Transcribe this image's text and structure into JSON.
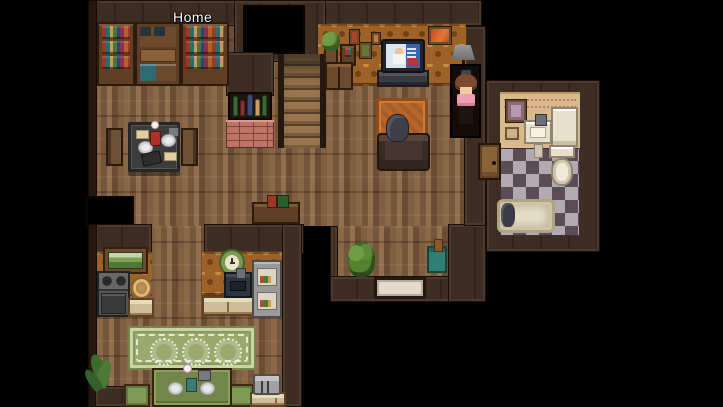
{
  "hud": {
    "map_name": "Home"
  },
  "scene": {
    "type": "top-down RPG house interior",
    "rooms": [
      "library-dining",
      "living-room",
      "bathroom",
      "kitchen",
      "entry-hall"
    ],
    "characters": {
      "player": "girl with brown hair, dark bow and pink dress standing in doorway",
      "npc": "dark-haired person sitting on sofa facing TV"
    },
    "objects": [
      "bookshelf",
      "china-hutch",
      "stairwell-opening",
      "staircase",
      "wine-rack",
      "brick-hearth",
      "dining-table",
      "dining-chairs",
      "low-bookshelf",
      "potted-plant",
      "wall-shelf",
      "small-cabinet",
      "picture-frames",
      "tv",
      "tv-stand",
      "wall-art",
      "floor-lamp",
      "orange-rug",
      "sofa",
      "bathroom-door",
      "bathroom-picture",
      "light-switch",
      "bathroom-sink",
      "white-cabinet",
      "toilet",
      "bathtub",
      "landscape-painting",
      "stove",
      "basket",
      "kitchen-counter",
      "wall-clock",
      "kitchen-sink",
      "pantry-fridge",
      "green-rug",
      "kitchen-table",
      "kitchen-chairs",
      "toaster",
      "corner-plant",
      "shrub",
      "green-bin",
      "doormat"
    ]
  },
  "palette": {
    "background": "#000000",
    "wall": "#3e2d22",
    "floor_wood": "#7d5c3d",
    "wallpaper_orange": "#9e6226",
    "bathroom_wall": "#d9ba8c",
    "checker_dark": "#5c4c56",
    "checker_light": "#b2aab2",
    "rug_green": "#9aa96e",
    "rug_orange": "#b9662a",
    "player_dress_pink": "#ee9fb6",
    "label_text": "#ffffff"
  }
}
